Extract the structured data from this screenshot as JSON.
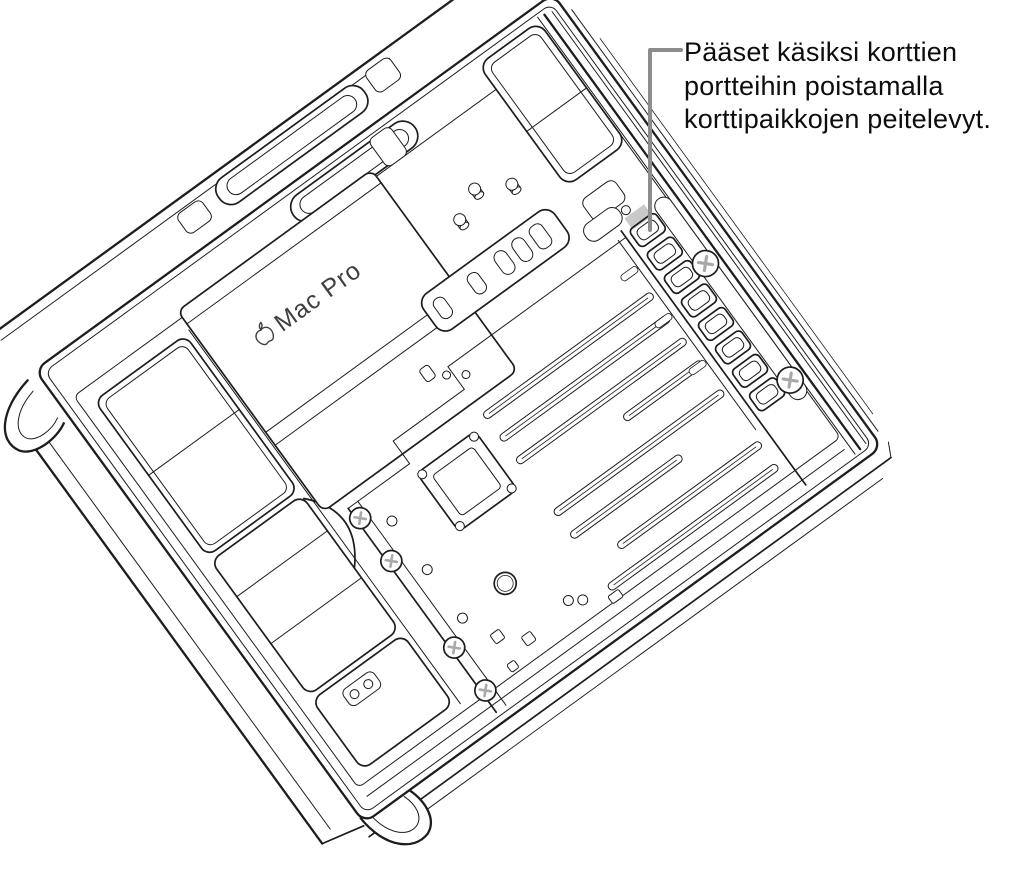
{
  "caption": {
    "lines": [
      "Pääset käsiksi korttien",
      "portteihin poistamalla",
      "korttipaikkojen peitelevyt."
    ]
  },
  "illustration": {
    "device_label": "Mac Pro",
    "highlighted_part": "pcie-slot-cover-1"
  },
  "colors": {
    "background": "#ffffff",
    "line": "#1d1d1d",
    "callout_line": "#8c8c8c",
    "highlight": "#c9c9c9",
    "label_text": "#3f3f3f",
    "caption_text": "#0d0d0d"
  }
}
